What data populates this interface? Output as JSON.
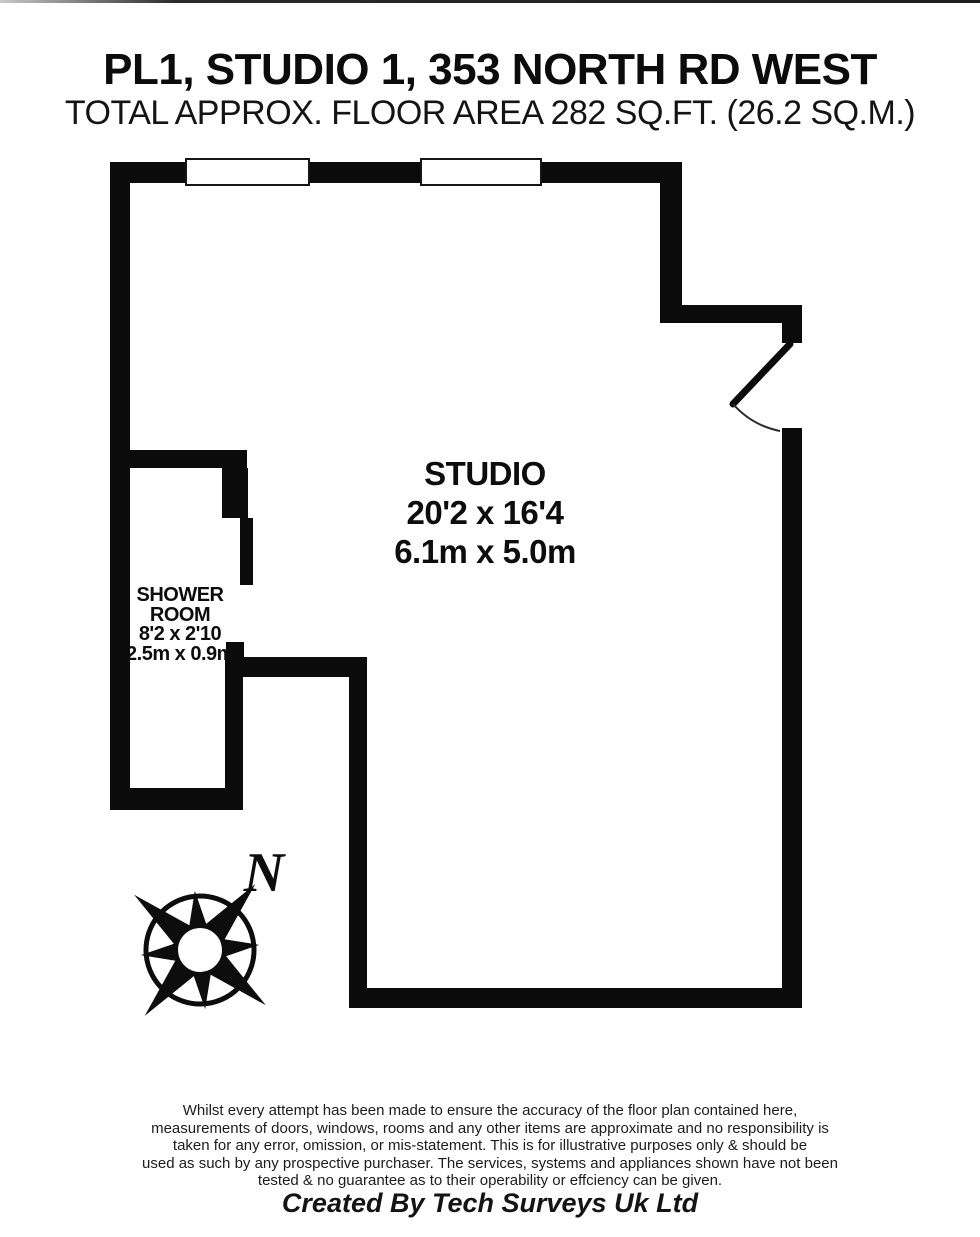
{
  "header": {
    "title": "PL1, STUDIO 1, 353 NORTH RD WEST",
    "subtitle": "TOTAL APPROX. FLOOR AREA 282 SQ.FT. (26.2 SQ.M.)"
  },
  "floorplan": {
    "rooms": [
      {
        "name": "STUDIO",
        "size_imperial": "20'2 x 16'4",
        "size_metric": "6.1m x 5.0m"
      },
      {
        "name_line1": "SHOWER",
        "name_line2": "ROOM",
        "size_imperial": "8'2 x 2'10",
        "size_metric": "2.5m x 0.9m"
      }
    ],
    "compass": {
      "north_label": "N"
    }
  },
  "footer": {
    "disclaimer_lines": [
      "Whilst every attempt has been made to ensure the accuracy of the floor plan contained here,",
      "measurements of doors, windows, rooms and any other items are approximate and no responsibility is",
      "taken for any error, omission, or mis-statement. This is for illustrative purposes only & should be",
      "used as such by any prospective purchaser. The services, systems and appliances shown have not been",
      "tested & no guarantee as to their operability or effciency can be given."
    ],
    "credit": "Created By Tech Surveys Uk Ltd"
  },
  "colors": {
    "wall": "#0b0b0b",
    "background": "#ffffff",
    "text": "#111111"
  }
}
